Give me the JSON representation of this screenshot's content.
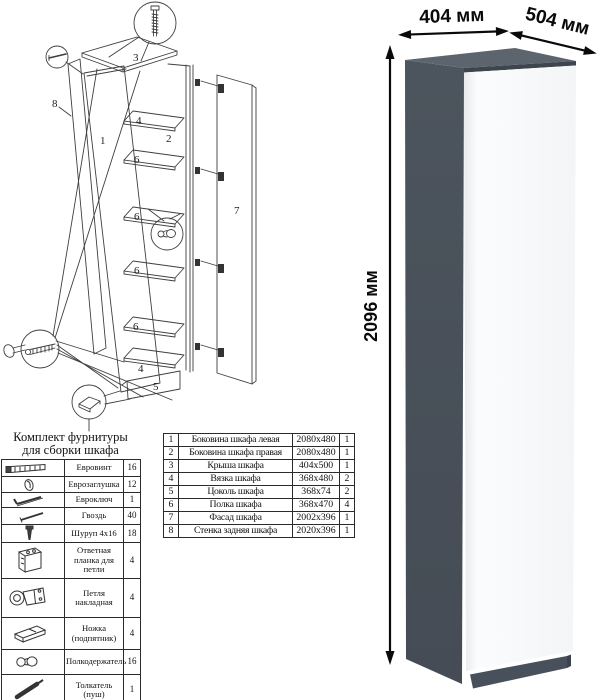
{
  "diagram": {
    "labels": {
      "side_left": "1",
      "side_right": "2",
      "roof": "3",
      "tie": "4",
      "plinth": "5",
      "shelf": "6",
      "facade": "7",
      "back": "8"
    }
  },
  "hardware_kit": {
    "title_line1": "Комплект фурнитуры",
    "title_line2": "для сборки шкафа",
    "items": [
      {
        "icon": "euro-screw",
        "name": "Евровинт",
        "qty": "16"
      },
      {
        "icon": "euro-cap",
        "name": "Еврозаглушка",
        "qty": "12"
      },
      {
        "icon": "hex-key",
        "name": "Евроключ",
        "qty": "1"
      },
      {
        "icon": "nail",
        "name": "Гвоздь",
        "qty": "40"
      },
      {
        "icon": "screw",
        "name": "Шуруп 4x16",
        "qty": "18"
      },
      {
        "icon": "strike-plate",
        "name": "Ответная планка для петли",
        "qty": "4"
      },
      {
        "icon": "hinge",
        "name": "Петля накладная",
        "qty": "4"
      },
      {
        "icon": "foot",
        "name": "Ножка (подпятник)",
        "qty": "4"
      },
      {
        "icon": "shelf-holder",
        "name": "Полкодержатель",
        "qty": "16"
      },
      {
        "icon": "push-opener",
        "name": "Толкатель (пуш)",
        "qty": "1"
      }
    ]
  },
  "parts_table": {
    "rows": [
      {
        "num": "1",
        "name": "Боковина шкафа левая",
        "size": "2080x480",
        "qty": "1"
      },
      {
        "num": "2",
        "name": "Боковина шкафа правая",
        "size": "2080x480",
        "qty": "1"
      },
      {
        "num": "3",
        "name": "Крыша шкафа",
        "size": "404x500",
        "qty": "1"
      },
      {
        "num": "4",
        "name": "Вязка шкафа",
        "size": "368x480",
        "qty": "2"
      },
      {
        "num": "5",
        "name": "Цоколь шкафа",
        "size": "368x74",
        "qty": "2"
      },
      {
        "num": "6",
        "name": "Полка шкафа",
        "size": "368x470",
        "qty": "4"
      },
      {
        "num": "7",
        "name": "Фасад шкафа",
        "size": "2002x396",
        "qty": "1"
      },
      {
        "num": "8",
        "name": "Стенка задняя шкафа",
        "size": "2020x396",
        "qty": "1"
      }
    ]
  },
  "render": {
    "dim_width": "404 мм",
    "dim_depth": "504 мм",
    "dim_height": "2096 мм",
    "colors": {
      "side": "#4c545d",
      "top": "#5c646e",
      "edge": "#3e454d",
      "door": "#fbfcfd",
      "plinth": "#48515b"
    }
  }
}
